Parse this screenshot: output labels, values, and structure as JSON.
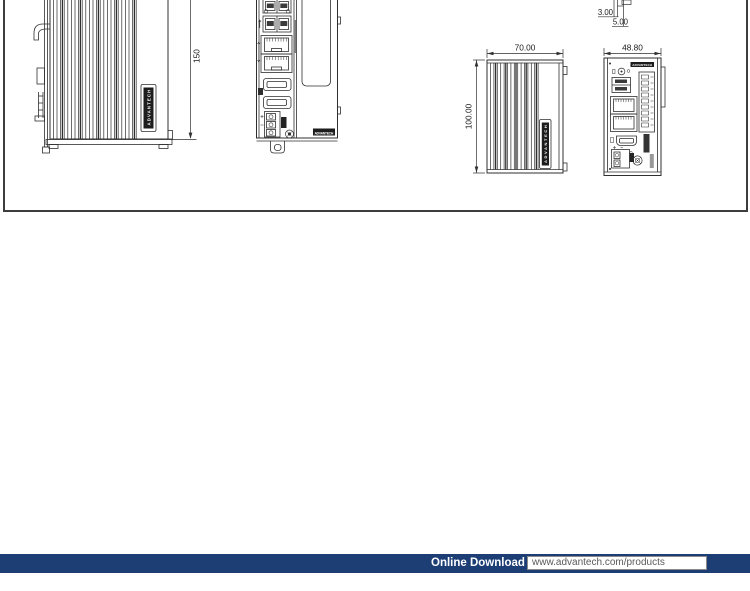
{
  "figure": {
    "brand_logo_text": "ADVANTECH",
    "views": {
      "side_din_rail": {
        "height": "150"
      },
      "side_fins": {
        "width": "70.00",
        "height": "100.00"
      },
      "front_compact": {
        "width": "48.80"
      },
      "detail_top": {
        "dim_small": "3.00",
        "dim_large": "5.00"
      }
    }
  },
  "footer": {
    "label": "Online Download",
    "url": "www.advantech.com/products",
    "bar_color": "#1c3e74"
  },
  "colors": {
    "line": "#2f2f2f",
    "figure_border": "#3d3d3d"
  }
}
